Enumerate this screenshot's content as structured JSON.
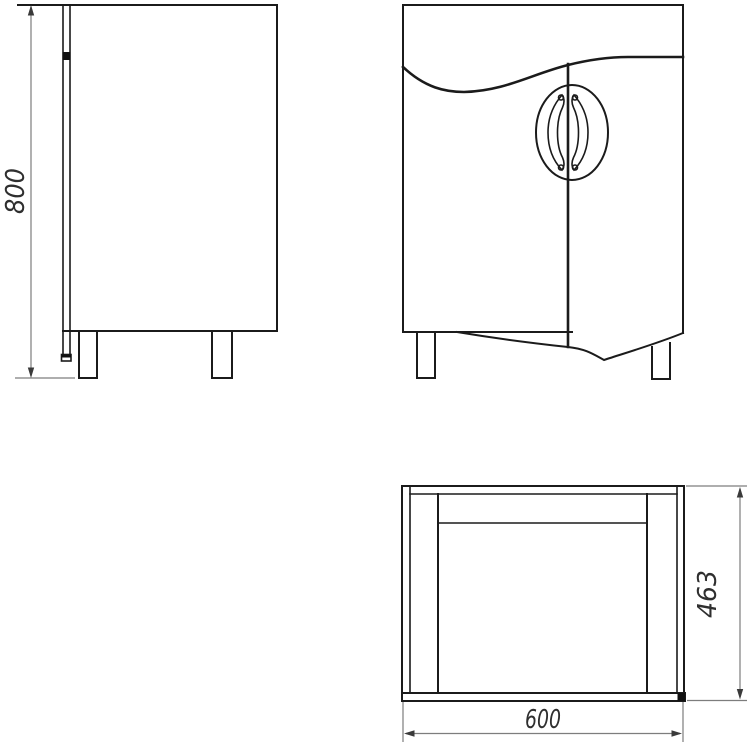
{
  "drawing": {
    "background": "#ffffff",
    "object_line_color": "#1b1b1b",
    "dimension_line_color": "#7d7d7d",
    "dimension_text_color": "#2f2f2f",
    "dimensions": {
      "height": {
        "value": "800"
      },
      "depth": {
        "value": "463"
      },
      "width": {
        "value": "600"
      }
    }
  }
}
